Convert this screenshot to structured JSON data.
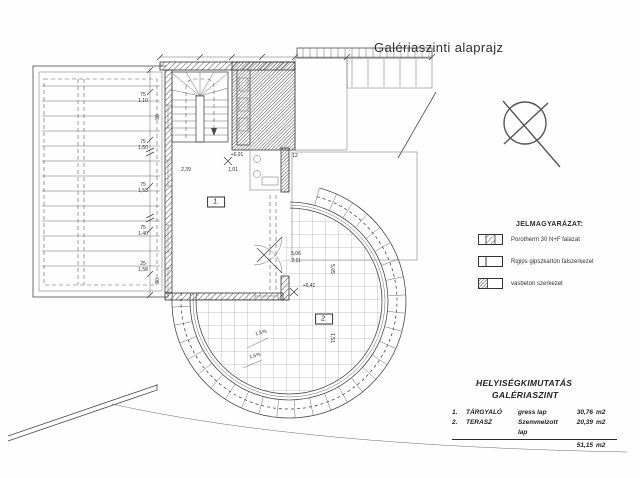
{
  "page": {
    "title": "Galériaszinti alaprajz"
  },
  "north": {
    "icon": "north-arrow"
  },
  "legend": {
    "title": "JELMAGYARÁZAT:",
    "items": [
      {
        "symbol": "porotherm-hatch-swatch",
        "label": "Porotherm 30 N+F falazat"
      },
      {
        "symbol": "rigips-partition-swatch",
        "label": "Rigips gipszkarton falszerkezet"
      },
      {
        "symbol": "reinforced-concrete-swatch",
        "label": "vasbeton szerkezet"
      }
    ]
  },
  "schedule": {
    "title_line1": "HELYISÉGKIMUTATÁS",
    "title_line2": "GALÉRIASZINT",
    "rows": [
      {
        "num": "1.",
        "name": "TÁRGYALÓ",
        "finish": "gress lap",
        "area": "30,76",
        "unit": "m2"
      },
      {
        "num": "2.",
        "name": "TERASZ",
        "finish": "Szemmelzott lap",
        "area": "20,39",
        "unit": "m2"
      }
    ],
    "total": {
      "area": "51,15",
      "unit": "m2"
    }
  },
  "plan": {
    "rooms": [
      {
        "num": "1.",
        "x": 216,
        "y": 202
      },
      {
        "num": "2.",
        "x": 324,
        "y": 319
      }
    ],
    "levels": [
      "+6,91",
      "+6,41"
    ],
    "dims": [
      {
        "t": "75",
        "x": 143,
        "y": 95
      },
      {
        "t": "1,10",
        "x": 143,
        "y": 101
      },
      {
        "t": "75",
        "x": 143,
        "y": 142
      },
      {
        "t": "1,50",
        "x": 143,
        "y": 148
      },
      {
        "t": "75",
        "x": 143,
        "y": 185
      },
      {
        "t": "1,53",
        "x": 143,
        "y": 191
      },
      {
        "t": "75",
        "x": 143,
        "y": 228
      },
      {
        "t": "1,40",
        "x": 143,
        "y": 234
      },
      {
        "t": "25",
        "x": 143,
        "y": 264
      },
      {
        "t": "1,58",
        "x": 143,
        "y": 270
      },
      {
        "t": "90",
        "x": 158,
        "y": 117,
        "r": -90
      },
      {
        "t": "90",
        "x": 158,
        "y": 281,
        "r": -90
      },
      {
        "t": "2,39",
        "x": 186,
        "y": 170
      },
      {
        "t": "1,01",
        "x": 233,
        "y": 170
      },
      {
        "t": "+6,91",
        "x": 237,
        "y": 155
      },
      {
        "t": "+6,41",
        "x": 309,
        "y": 286
      },
      {
        "t": "5,06",
        "x": 296,
        "y": 254
      },
      {
        "t": "2,11",
        "x": 296,
        "y": 261
      },
      {
        "t": "12",
        "x": 295,
        "y": 156
      },
      {
        "t": "1,5%",
        "x": 261,
        "y": 333,
        "r": -15
      },
      {
        "t": "1,5%",
        "x": 255,
        "y": 356,
        "r": -15
      },
      {
        "t": "5,05",
        "x": 332,
        "y": 269,
        "r": 90
      },
      {
        "t": "1,51",
        "x": 332,
        "y": 338,
        "r": 90
      }
    ]
  }
}
